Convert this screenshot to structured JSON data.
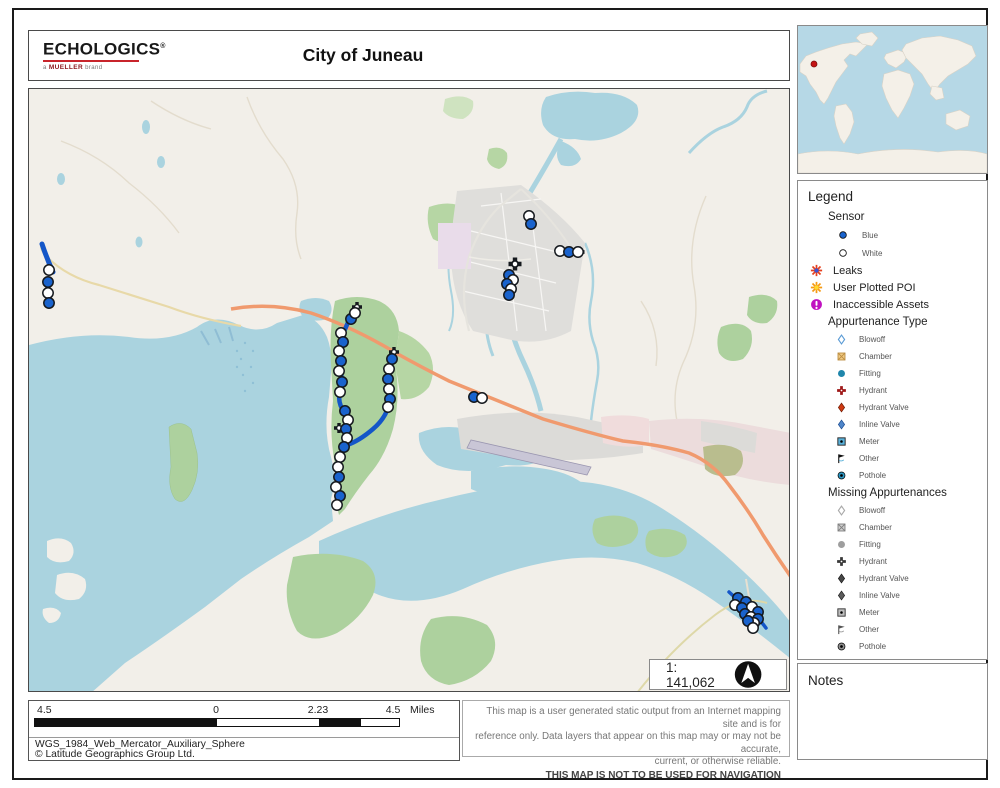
{
  "header": {
    "logo": "ECHOLOGICS",
    "logo_mark": "®",
    "brand": {
      "prefix": "a",
      "name": "MUELLER",
      "suffix": "brand"
    },
    "title": "City of Juneau"
  },
  "inset": {
    "marker": {
      "x": 16,
      "y": 38
    },
    "marker_color": "#c41414"
  },
  "legend": {
    "title": "Legend",
    "sensor": {
      "label": "Sensor",
      "items": [
        {
          "label": "Blue",
          "icon": "sensor_blue"
        },
        {
          "label": "White",
          "icon": "sensor_white"
        }
      ]
    },
    "items": [
      {
        "label": "Leaks",
        "icon": "leaks"
      },
      {
        "label": "User Plotted POI",
        "icon": "poi"
      },
      {
        "label": "Inaccessible Assets",
        "icon": "inaccess"
      }
    ],
    "appurtenance": {
      "title": "Appurtenance Type",
      "items": [
        {
          "label": "Blowoff",
          "icon": "blowoff"
        },
        {
          "label": "Chamber",
          "icon": "chamber"
        },
        {
          "label": "Fitting",
          "icon": "fitting"
        },
        {
          "label": "Hydrant",
          "icon": "hydrant"
        },
        {
          "label": "Hydrant Valve",
          "icon": "hydrantvalve"
        },
        {
          "label": "Inline Valve",
          "icon": "inlinevalve"
        },
        {
          "label": "Meter",
          "icon": "meter"
        },
        {
          "label": "Other",
          "icon": "other"
        },
        {
          "label": "Pothole",
          "icon": "pothole"
        }
      ]
    },
    "missing": {
      "title": "Missing Appurtenances",
      "items": [
        {
          "label": "Blowoff",
          "icon": "blowoff"
        },
        {
          "label": "Chamber",
          "icon": "chamber"
        },
        {
          "label": "Fitting",
          "icon": "fitting"
        },
        {
          "label": "Hydrant",
          "icon": "hydrant"
        },
        {
          "label": "Hydrant Valve",
          "icon": "hydrantvalve"
        },
        {
          "label": "Inline Valve",
          "icon": "inlinevalve"
        },
        {
          "label": "Meter",
          "icon": "meter"
        },
        {
          "label": "Other",
          "icon": "other"
        },
        {
          "label": "Pothole",
          "icon": "pothole"
        }
      ]
    }
  },
  "notes": {
    "title": "Notes"
  },
  "map": {
    "scale_text": "1: 141,062",
    "colors": {
      "sensor_blue": "#1a63cd",
      "sensor_white": "#ffffff",
      "stroke": "#15191e",
      "pipe": "#1456c8"
    },
    "pipelines": [
      {
        "d": "M41,243 Q46,258 52,271",
        "w": 5
      },
      {
        "d": "M354,308 Q346,322 341,336 Q337,350 339,364 Q342,377 339,391 Q336,402 344,412 Q348,424 345,436 Q342,450 338,462 Q335,476 337,488 Q339,498 336,506",
        "w": 4.5
      },
      {
        "d": "M392,352 Q389,367 388,380 Q390,394 388,404 Q384,418 372,428 Q358,440 346,444",
        "w": 4.5
      },
      {
        "d": "M728,591 Q740,602 752,612 Q760,620 765,627",
        "w": 3.5
      }
    ],
    "sensors": [
      {
        "x": 48,
        "y": 269,
        "c": "w"
      },
      {
        "x": 47,
        "y": 281,
        "c": "b"
      },
      {
        "x": 47,
        "y": 292,
        "c": "w"
      },
      {
        "x": 48,
        "y": 302,
        "c": "b"
      },
      {
        "x": 350,
        "y": 318,
        "c": "b"
      },
      {
        "x": 354,
        "y": 312,
        "c": "w"
      },
      {
        "x": 340,
        "y": 332,
        "c": "w"
      },
      {
        "x": 342,
        "y": 341,
        "c": "b"
      },
      {
        "x": 338,
        "y": 350,
        "c": "w"
      },
      {
        "x": 340,
        "y": 360,
        "c": "b"
      },
      {
        "x": 338,
        "y": 370,
        "c": "w"
      },
      {
        "x": 341,
        "y": 381,
        "c": "b"
      },
      {
        "x": 339,
        "y": 391,
        "c": "w"
      },
      {
        "x": 344,
        "y": 410,
        "c": "b"
      },
      {
        "x": 347,
        "y": 419,
        "c": "w"
      },
      {
        "x": 345,
        "y": 428,
        "c": "b"
      },
      {
        "x": 346,
        "y": 437,
        "c": "w"
      },
      {
        "x": 343,
        "y": 446,
        "c": "b"
      },
      {
        "x": 339,
        "y": 456,
        "c": "w"
      },
      {
        "x": 337,
        "y": 466,
        "c": "w"
      },
      {
        "x": 338,
        "y": 476,
        "c": "b"
      },
      {
        "x": 335,
        "y": 486,
        "c": "w"
      },
      {
        "x": 339,
        "y": 495,
        "c": "b"
      },
      {
        "x": 336,
        "y": 504,
        "c": "w"
      },
      {
        "x": 391,
        "y": 358,
        "c": "b"
      },
      {
        "x": 388,
        "y": 368,
        "c": "w"
      },
      {
        "x": 387,
        "y": 378,
        "c": "b"
      },
      {
        "x": 388,
        "y": 388,
        "c": "w"
      },
      {
        "x": 389,
        "y": 398,
        "c": "b"
      },
      {
        "x": 387,
        "y": 406,
        "c": "w"
      },
      {
        "x": 528,
        "y": 215,
        "c": "w"
      },
      {
        "x": 530,
        "y": 223,
        "c": "b"
      },
      {
        "x": 559,
        "y": 250,
        "c": "w"
      },
      {
        "x": 568,
        "y": 251,
        "c": "b"
      },
      {
        "x": 577,
        "y": 251,
        "c": "w"
      },
      {
        "x": 508,
        "y": 274,
        "c": "b"
      },
      {
        "x": 512,
        "y": 279,
        "c": "w"
      },
      {
        "x": 506,
        "y": 283,
        "c": "b"
      },
      {
        "x": 510,
        "y": 288,
        "c": "w"
      },
      {
        "x": 508,
        "y": 294,
        "c": "b"
      },
      {
        "x": 473,
        "y": 396,
        "c": "b"
      },
      {
        "x": 481,
        "y": 397,
        "c": "w"
      },
      {
        "x": 737,
        "y": 597,
        "c": "b"
      },
      {
        "x": 745,
        "y": 601,
        "c": "b"
      },
      {
        "x": 734,
        "y": 604,
        "c": "w"
      },
      {
        "x": 741,
        "y": 607,
        "c": "b"
      },
      {
        "x": 751,
        "y": 606,
        "c": "w"
      },
      {
        "x": 757,
        "y": 611,
        "c": "b"
      },
      {
        "x": 744,
        "y": 613,
        "c": "b"
      },
      {
        "x": 750,
        "y": 616,
        "c": "w"
      },
      {
        "x": 757,
        "y": 618,
        "c": "b"
      },
      {
        "x": 753,
        "y": 622,
        "c": "w"
      },
      {
        "x": 747,
        "y": 620,
        "c": "b"
      },
      {
        "x": 752,
        "y": 627,
        "c": "w"
      }
    ],
    "hydrants": [
      {
        "x": 356,
        "y": 306,
        "s": 10
      },
      {
        "x": 393,
        "y": 351,
        "s": 10
      },
      {
        "x": 338,
        "y": 427,
        "s": 10
      },
      {
        "x": 514,
        "y": 263,
        "s": 13
      },
      {
        "x": 578,
        "y": 251,
        "s": 11
      }
    ]
  },
  "scalebar": {
    "labels": [
      "4.5",
      "0",
      "2.23",
      "4.5"
    ],
    "unit": "Miles",
    "segments": [
      {
        "w": 182,
        "fill": "#111111"
      },
      {
        "w": 102,
        "fill": "#ffffff"
      },
      {
        "w": 42,
        "fill": "#111111"
      },
      {
        "w": 38,
        "fill": "#ffffff"
      }
    ]
  },
  "footer": {
    "projection": "WGS_1984_Web_Mercator_Auxiliary_Sphere",
    "copyright": "© Latitude Geographics Group Ltd."
  },
  "disclaimer": {
    "lines": [
      "This map is a user generated static output from an Internet mapping site and is for",
      "reference only. Data layers that appear on this map may or may not be accurate,",
      "current, or otherwise reliable."
    ],
    "warning": "THIS MAP IS NOT TO BE USED FOR NAVIGATION"
  }
}
